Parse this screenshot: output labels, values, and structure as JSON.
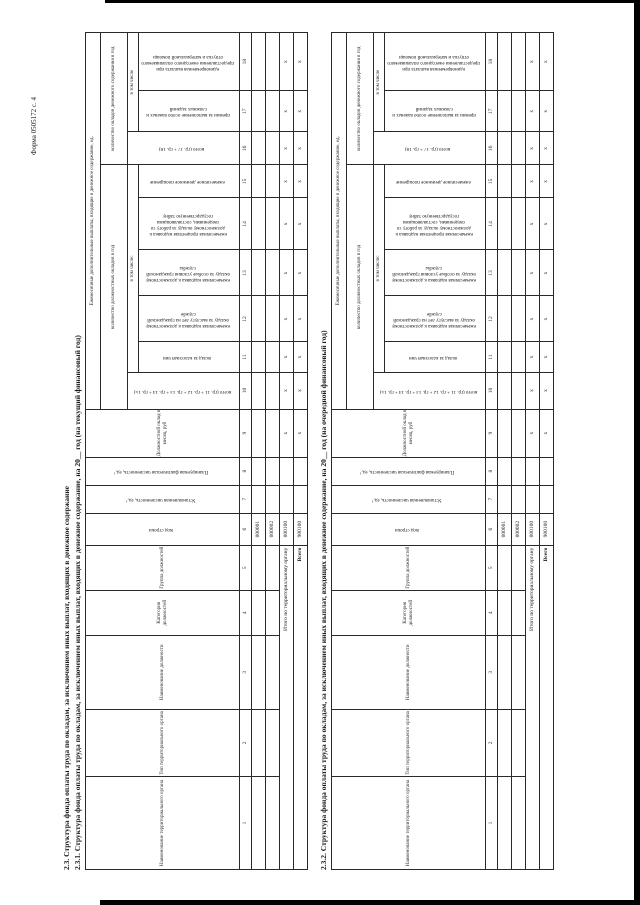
{
  "colors": {
    "ink": "#1a1a1a",
    "paper": "#ffffff",
    "scan_edge": "#000000"
  },
  "page": {
    "form_code": "Форма 0505172 с. 4",
    "section_title": "2.3. Структура фонда оплаты труда по окладам, за исключением иных выплат, входящих в денежное содержание",
    "tables": [
      {
        "title": "2.3.1. Структура фонда оплаты труда по окладам, за исключением иных выплат, входящих в денежное содержание, на 20__ год (на текущий финансовый год)"
      },
      {
        "title": "2.3.2. Структура фонда оплаты труда по окладам, за исключением иных выплат, входящих в денежное содержание, на 20__ год (на очередной финансовый год)"
      }
    ]
  },
  "grid": {
    "c1": "Наименование территориального органа",
    "c2": "Тип территориального органа",
    "c3": "Наименование должности",
    "c4": "Категория должностей",
    "c5": "Группа должностей",
    "c6": "Код строки",
    "c7": "Установленная численность, ед.¹",
    "c8": "Планируемая фактическая численность, ед.¹",
    "c9": "Должностной оклад в месяц, руб",
    "g_monthly": "Ежемесячные дополнительные выплаты, входящие в денежное содержание, ед.",
    "g_oklady": "количество должностных окладов в год",
    "g_soderzh": "количество окладов денежного содержания в год",
    "c10": "всего (гр. 11 + гр. 12 + гр. 13 + гр. 14 + гр. 15)",
    "vtom1": "в том числе:",
    "c11": "оклад за классный чин",
    "c12": "ежемесячная надбавка к должностному окладу за выслугу лет на гражданской службе",
    "c13": "ежемесячная надбавка к должностному окладу за особые условия гражданской службы",
    "c14": "ежемесячная процентная надбавка к должностному окладу за работу со сведениями, составляющими государственную тайну",
    "c15": "ежемесячное денежное поощрение",
    "c16": "всего (гр. 17 + гр. 18)",
    "vtom2": "в том числе",
    "c17": "премии за выполнение особо важных и сложных заданий",
    "c18": "единовременная выплата при предоставлении ежегодного оплачиваемого отпуска и материальной помощи",
    "col_numbers": [
      "1",
      "2",
      "3",
      "4",
      "5",
      "6",
      "7",
      "8",
      "9",
      "10",
      "11",
      "12",
      "13",
      "14",
      "15",
      "16",
      "17",
      "18"
    ],
    "rows": [
      {
        "code": "000001"
      },
      {
        "code": "000002"
      },
      {
        "label": "Итого по территориальному органу",
        "code": "000100",
        "marks": [
          "x",
          "x",
          "x",
          "x",
          "x",
          "x",
          "x",
          "x",
          "x",
          "x"
        ]
      },
      {
        "label": "Всего",
        "code": "900100",
        "marks": [
          "x",
          "x",
          "x",
          "x",
          "x",
          "x",
          "x",
          "x",
          "x",
          "x"
        ]
      }
    ]
  }
}
